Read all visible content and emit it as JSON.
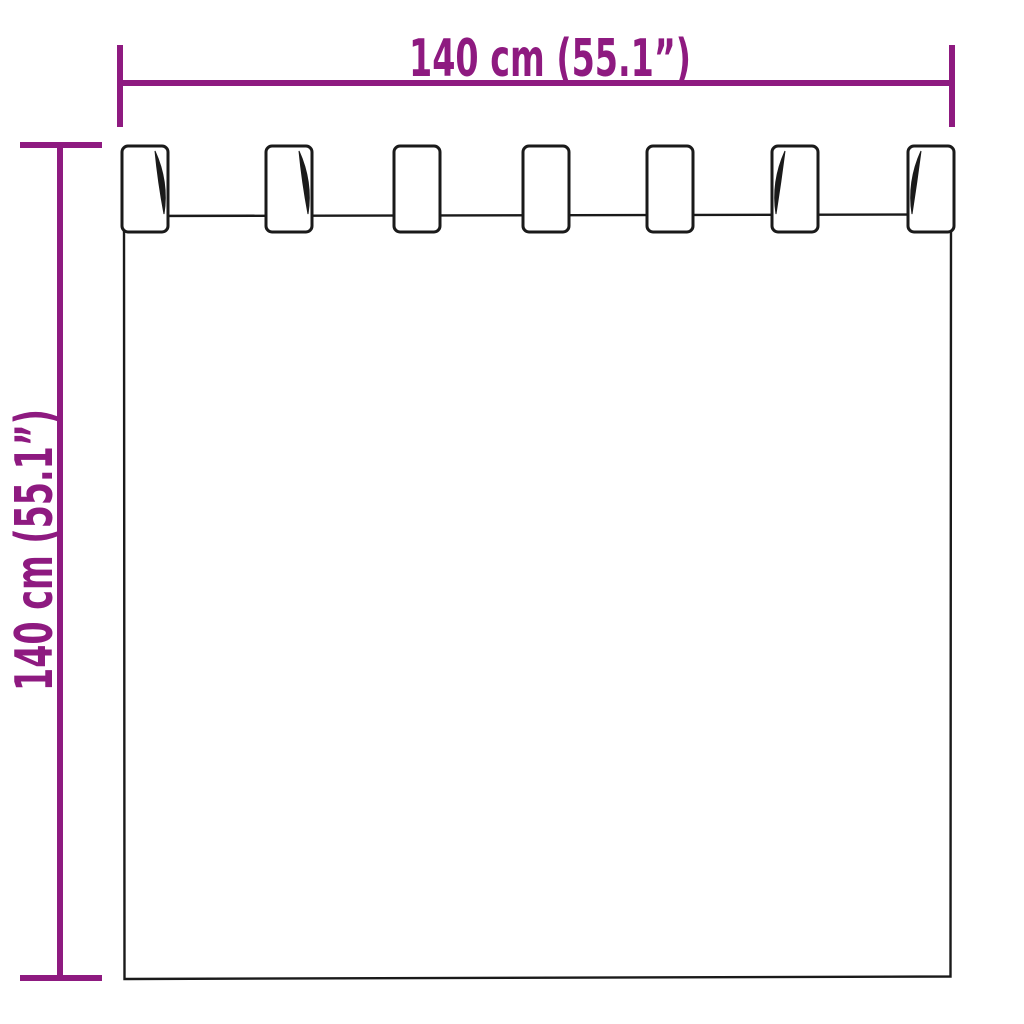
{
  "diagram": {
    "type": "product-dimension-diagram",
    "subject": "tab-top-curtain",
    "tab_count": 7,
    "dimensions": {
      "width": {
        "label": "140 cm (55.1”)"
      },
      "height": {
        "label": "140 cm (55.1”)"
      }
    },
    "colors": {
      "dimension_accent": "#8E1A80",
      "outline": "#1A1A1A",
      "background": "#FFFFFF"
    }
  }
}
